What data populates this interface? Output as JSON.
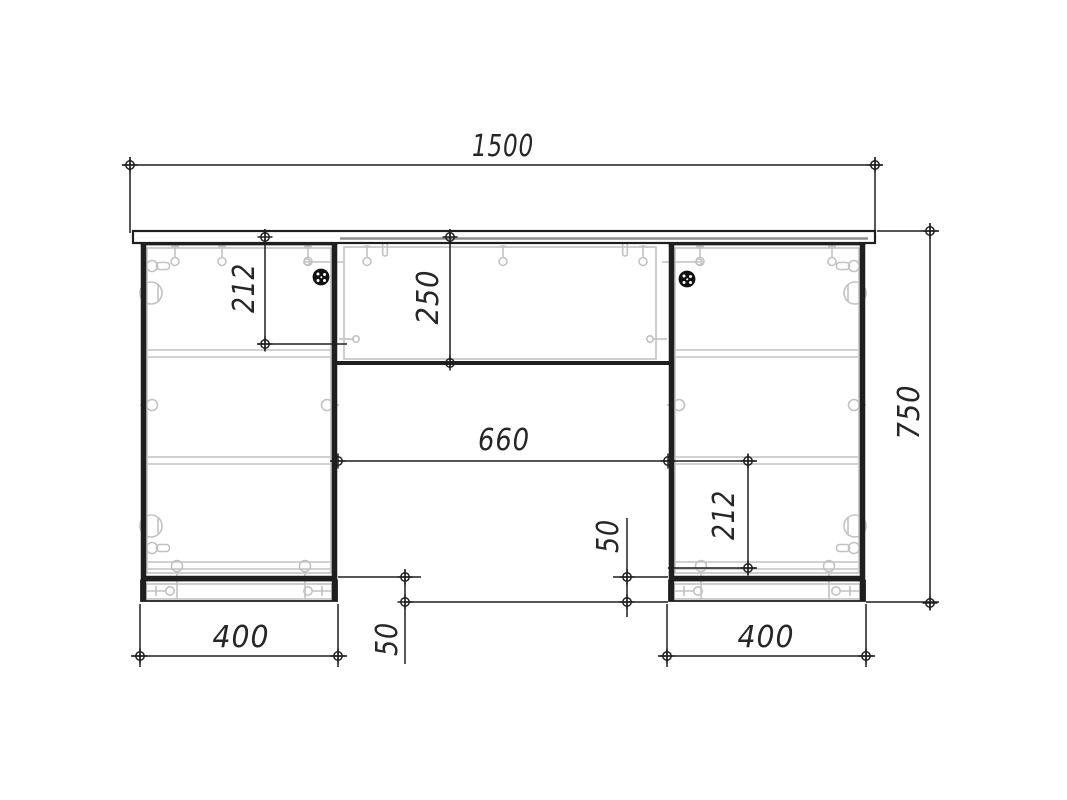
{
  "drawing": {
    "type": "furniture front-elevation technical drawing",
    "units": "mm"
  },
  "colors": {
    "background": "#ffffff",
    "structure_line": "#1f1f1f",
    "hardware_line": "#c2c2c2",
    "dimension_line": "#1f1f1f",
    "label_text": "#262626",
    "grommet_fill": "#111111"
  },
  "dimensions_mm": {
    "total_width": "1500",
    "total_height": "750",
    "left_top_shelf_offset": "212",
    "top_center_panel_height": "250",
    "knee_space_width": "660",
    "right_bottom_shelf_offset": "212",
    "left_pedestal_width": "400",
    "right_pedestal_width": "400",
    "left_plinth_height": "50",
    "center_plinth_height": "50"
  }
}
